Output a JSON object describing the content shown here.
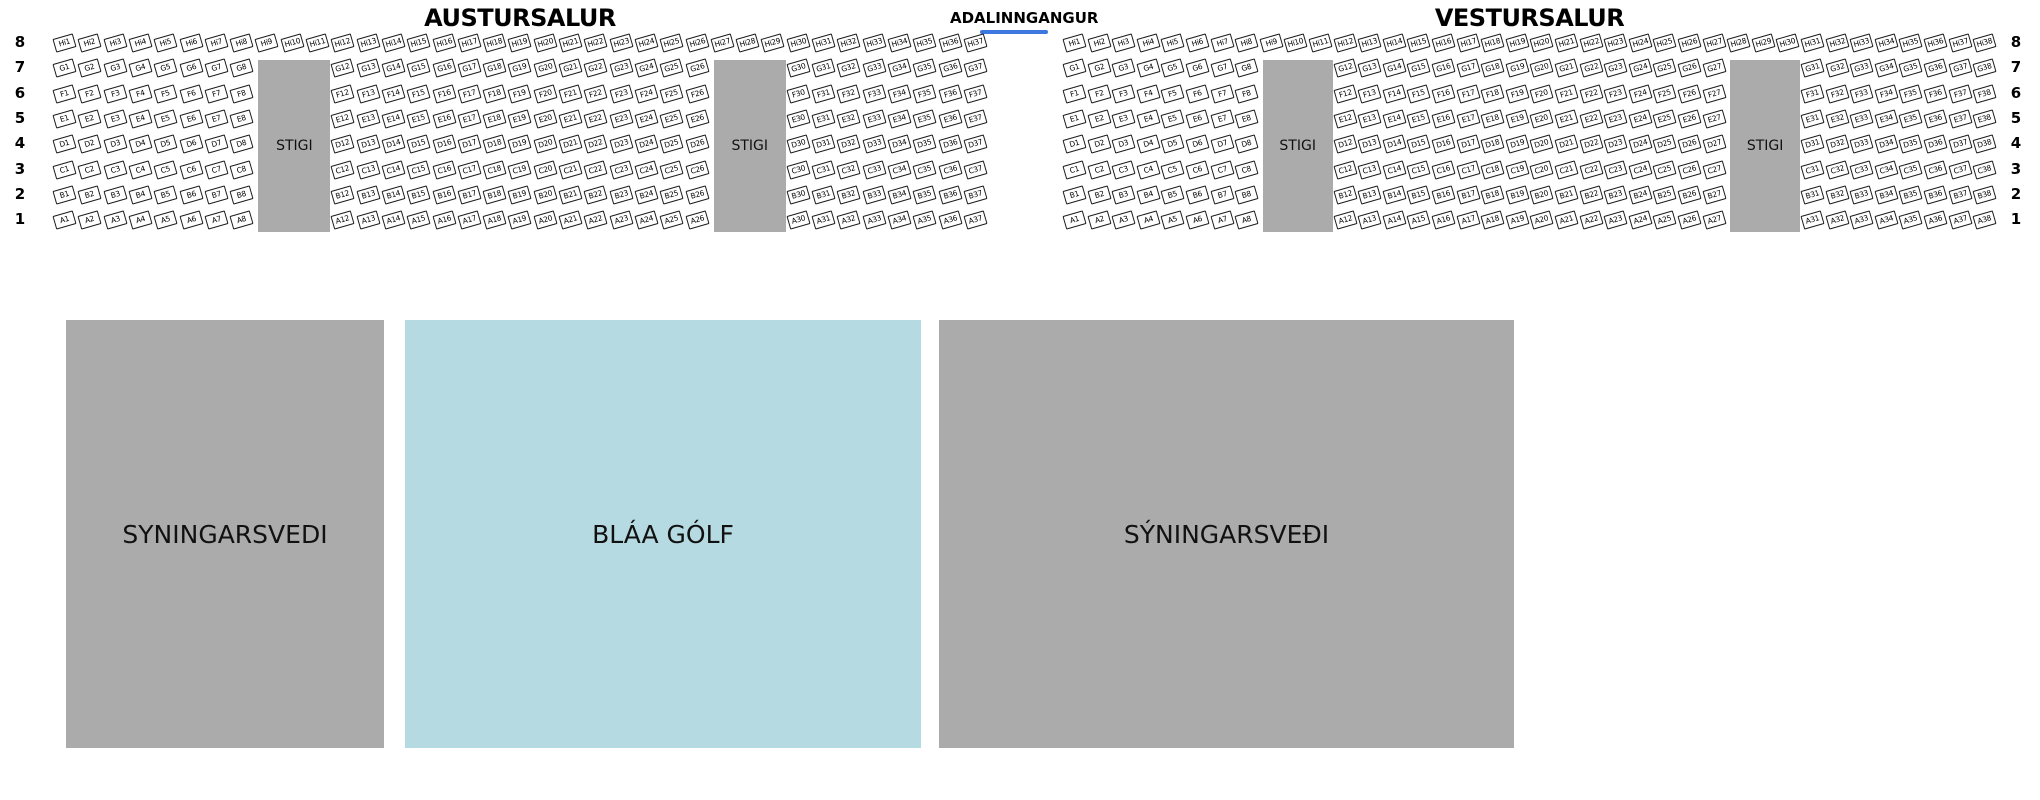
{
  "header": {
    "entrance_label": "ADALINNGANGUR"
  },
  "row_numbers": [
    "8",
    "7",
    "6",
    "5",
    "4",
    "3",
    "2",
    "1"
  ],
  "halls": [
    {
      "id": "austursalur",
      "title": "AUSTURSALUR",
      "rows": [
        {
          "letter": "Hi",
          "segments": [
            [
              1,
              37
            ]
          ]
        },
        {
          "letter": "G",
          "segments": [
            [
              1,
              8
            ],
            [
              12,
              26
            ],
            [
              30,
              37
            ]
          ]
        },
        {
          "letter": "F",
          "segments": [
            [
              1,
              8
            ],
            [
              12,
              26
            ],
            [
              30,
              37
            ]
          ]
        },
        {
          "letter": "E",
          "segments": [
            [
              1,
              8
            ],
            [
              12,
              26
            ],
            [
              30,
              37
            ]
          ]
        },
        {
          "letter": "D",
          "segments": [
            [
              1,
              8
            ],
            [
              12,
              26
            ],
            [
              30,
              37
            ]
          ]
        },
        {
          "letter": "C",
          "segments": [
            [
              1,
              8
            ],
            [
              12,
              26
            ],
            [
              30,
              37
            ]
          ]
        },
        {
          "letter": "B",
          "segments": [
            [
              1,
              8
            ],
            [
              12,
              26
            ],
            [
              30,
              37
            ]
          ]
        },
        {
          "letter": "A",
          "segments": [
            [
              1,
              8
            ],
            [
              12,
              26
            ],
            [
              30,
              37
            ]
          ]
        }
      ],
      "stairs": [
        {
          "label": "STIGI",
          "start_col": 9,
          "end_col": 11
        },
        {
          "label": "STIGI",
          "start_col": 27,
          "end_col": 29
        }
      ]
    },
    {
      "id": "vestursalur",
      "title": "VESTURSALUR",
      "rows": [
        {
          "letter": "Hi",
          "segments": [
            [
              1,
              38
            ]
          ]
        },
        {
          "letter": "G",
          "segments": [
            [
              1,
              8
            ],
            [
              12,
              27
            ],
            [
              31,
              38
            ]
          ]
        },
        {
          "letter": "F",
          "segments": [
            [
              1,
              8
            ],
            [
              12,
              27
            ],
            [
              31,
              38
            ]
          ]
        },
        {
          "letter": "E",
          "segments": [
            [
              1,
              8
            ],
            [
              12,
              27
            ],
            [
              31,
              38
            ]
          ]
        },
        {
          "letter": "D",
          "segments": [
            [
              1,
              8
            ],
            [
              12,
              27
            ],
            [
              31,
              38
            ]
          ]
        },
        {
          "letter": "C",
          "segments": [
            [
              1,
              8
            ],
            [
              12,
              27
            ],
            [
              31,
              38
            ]
          ]
        },
        {
          "letter": "B",
          "segments": [
            [
              1,
              8
            ],
            [
              12,
              27
            ],
            [
              31,
              38
            ]
          ]
        },
        {
          "letter": "A",
          "segments": [
            [
              1,
              8
            ],
            [
              12,
              27
            ],
            [
              31,
              38
            ]
          ]
        }
      ],
      "stairs": [
        {
          "label": "STIGI",
          "start_col": 9,
          "end_col": 11
        },
        {
          "label": "STIGI",
          "start_col": 28,
          "end_col": 30
        }
      ]
    }
  ],
  "floor_areas": [
    {
      "label": "SYNINGARSVEDI",
      "color": "#ABABAB"
    },
    {
      "label": "BLÁA GÓLF",
      "color": "#B5DAE2"
    },
    {
      "label": "SÝNINGARSVEÐI",
      "color": "#ABABAB"
    }
  ],
  "colors": {
    "stairs_fill": "#ABABAB",
    "entrance_underline": "#3C78DF",
    "seat_border": "#1B1B1B"
  }
}
